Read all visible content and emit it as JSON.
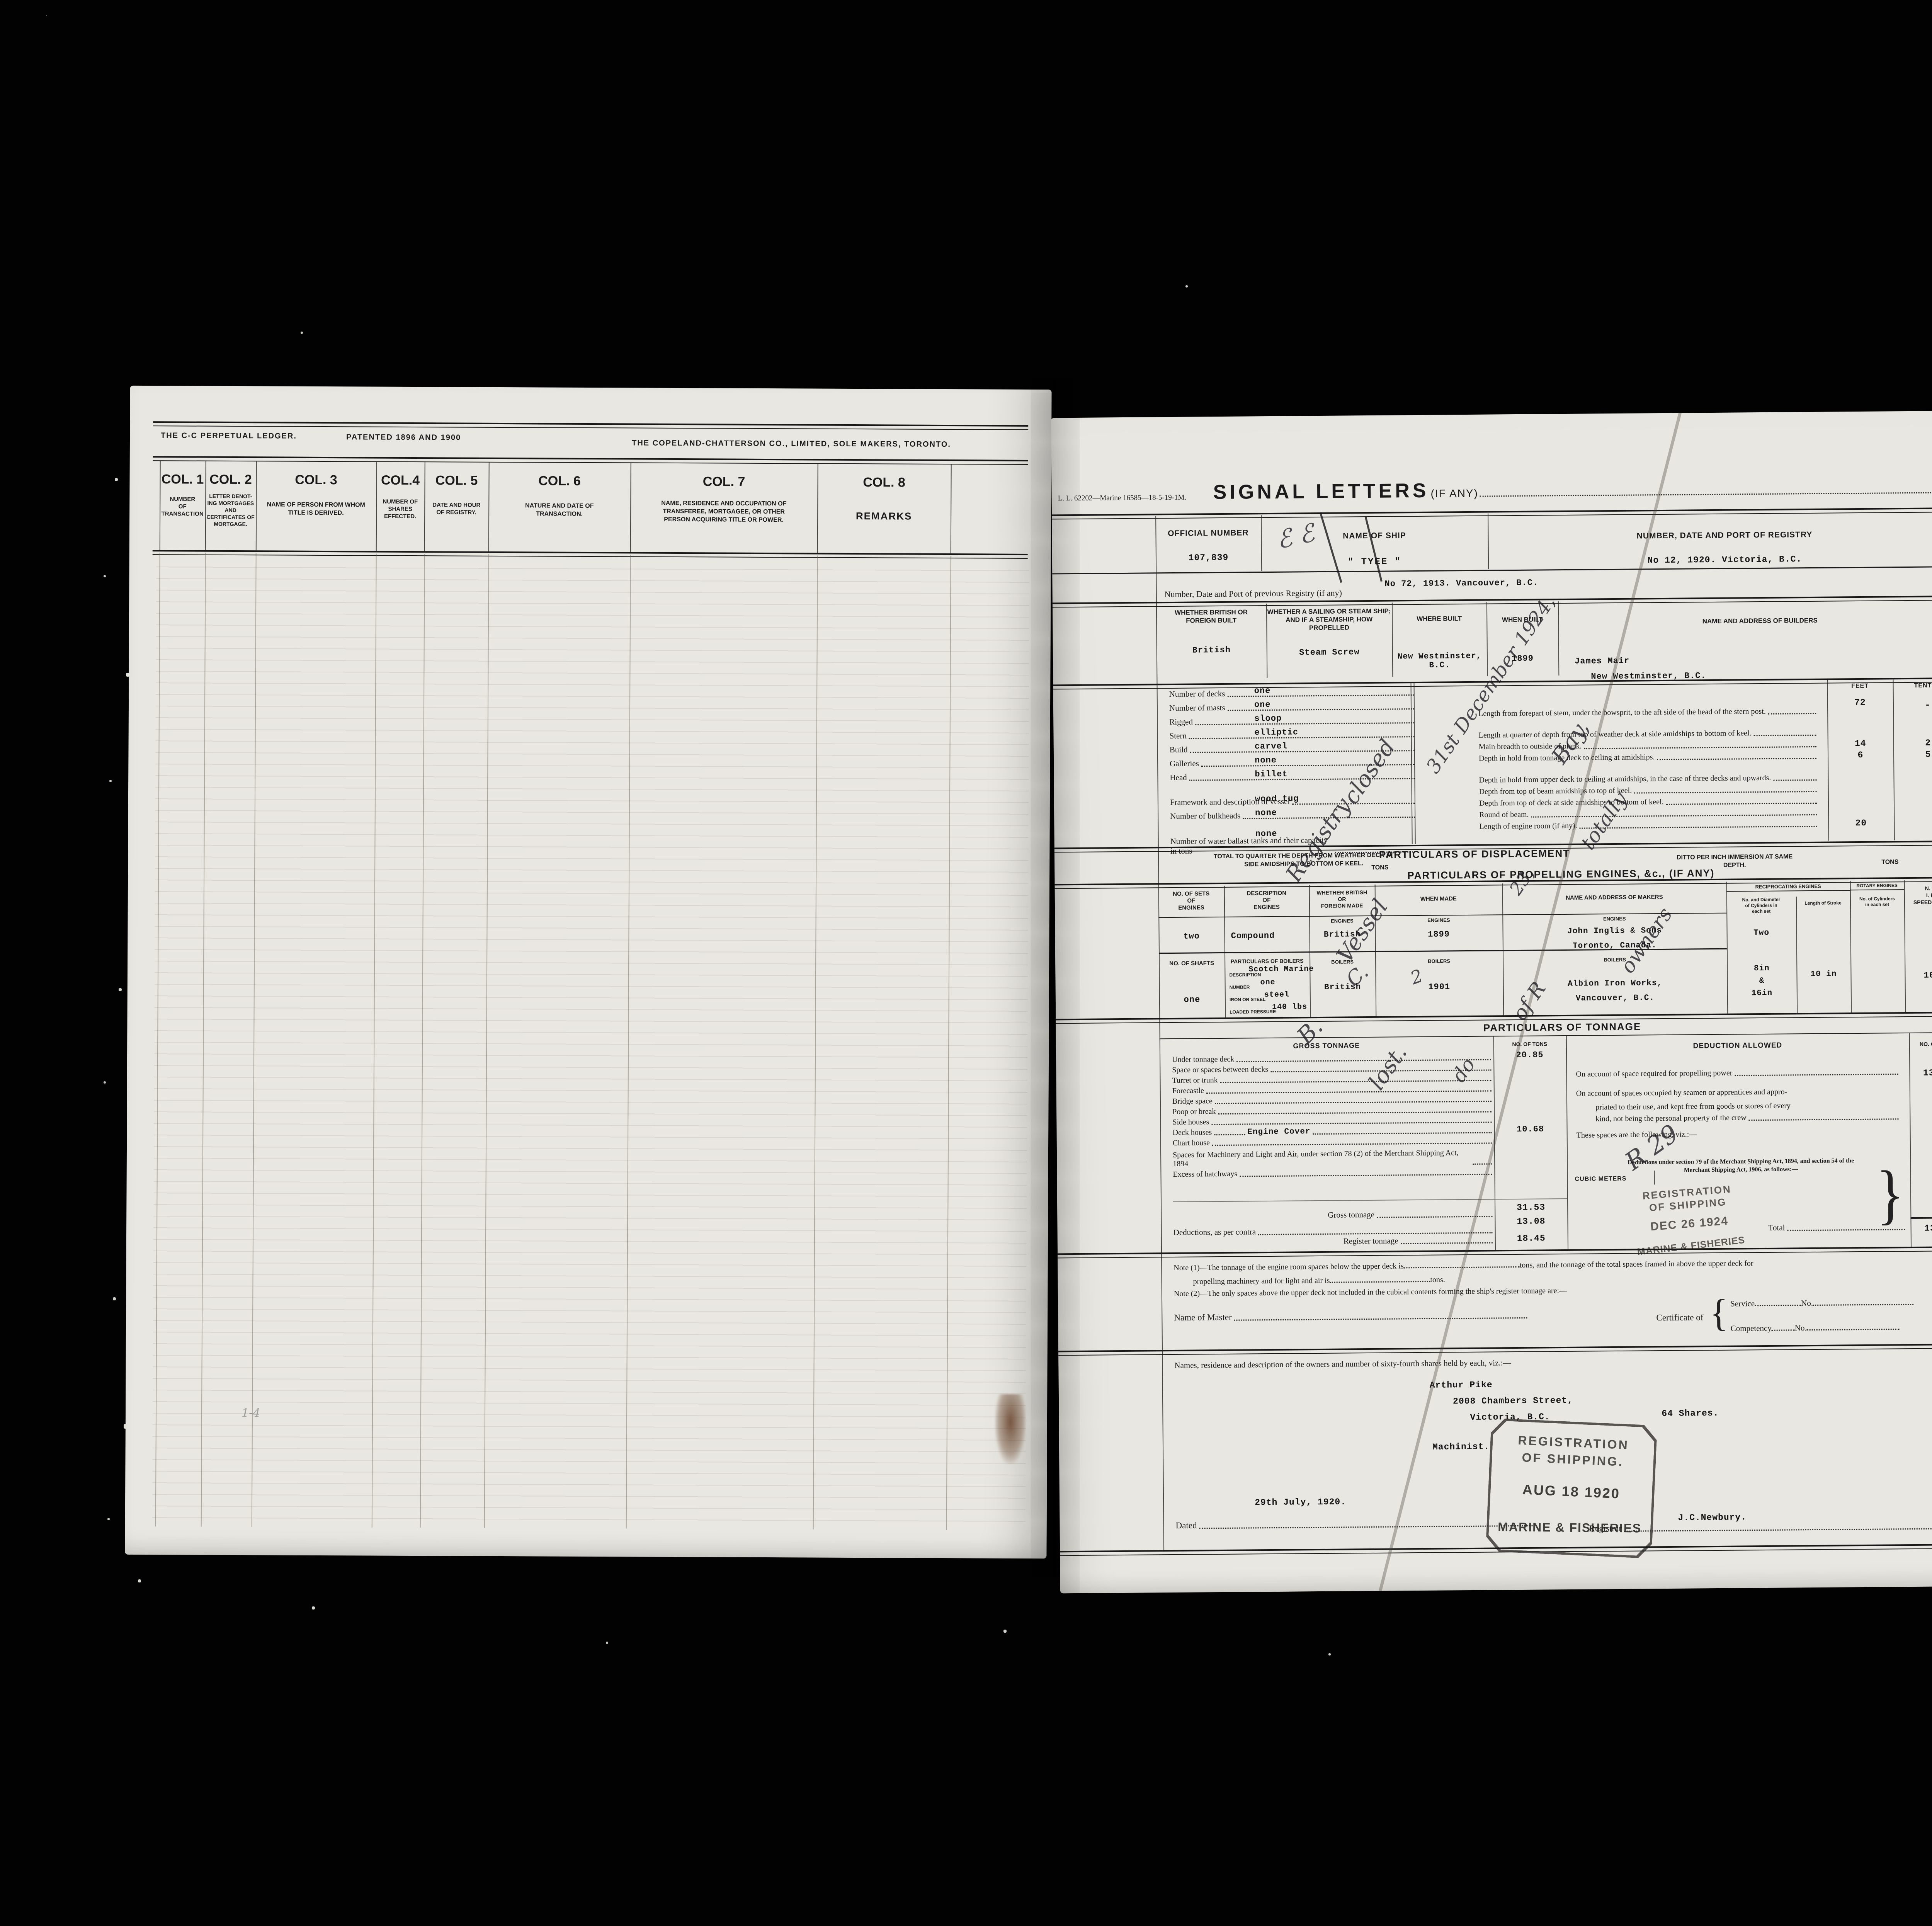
{
  "left_page": {
    "plate": {
      "maker_left": "THE C-C PERPETUAL LEDGER.",
      "patent": "PATENTED 1896 AND 1900",
      "maker_right": "THE COPELAND-CHATTERSON CO., LIMITED, SOLE MAKERS, TORONTO."
    },
    "columns": [
      {
        "title": "COL. 1",
        "desc": "NUMBER\nOF\nTRANSACTION"
      },
      {
        "title": "COL. 2",
        "desc": "LETTER DENOT-\nING MORTGAGES\nAND\nCERTIFICATES OF\nMORTGAGE."
      },
      {
        "title": "COL. 3",
        "desc": "NAME OF PERSON FROM WHOM\nTITLE IS DERIVED."
      },
      {
        "title": "COL.4",
        "desc": "NUMBER OF\nSHARES\nEFFECTED."
      },
      {
        "title": "COL. 5",
        "desc": "DATE AND HOUR\nOF REGISTRY."
      },
      {
        "title": "COL. 6",
        "desc": "NATURE AND DATE OF\nTRANSACTION."
      },
      {
        "title": "COL. 7",
        "desc": "NAME, RESIDENCE AND OCCUPATION OF\nTRANSFEREE, MORTGAGEE, OR OTHER\nPERSON ACQUIRING TITLE OR POWER."
      },
      {
        "title": "COL. 8",
        "desc": "REMARKS"
      }
    ]
  },
  "right_page": {
    "form_no": "L. L. 62202—Marine 16585—18-5-19-1M.",
    "signal": {
      "title": "SIGNAL LETTERS",
      "suffix": "(IF ANY)"
    },
    "registry": {
      "official_label": "OFFICIAL NUMBER",
      "official_value": "107,839",
      "ship_label": "NAME OF SHIP",
      "ship_value": "\" TYEE \"",
      "port_label": "NUMBER, DATE AND PORT OF REGISTRY",
      "port_value": "No 12, 1920. Victoria, B.C.",
      "previous_label": "Number, Date and Port of previous Registry (if any)",
      "previous_value": "No 72, 1913. Vancouver, B.C."
    },
    "build": {
      "h1": "WHETHER BRITISH OR\nFOREIGN BUILT",
      "v1": "British",
      "h2": "WHETHER A SAILING OR STEAM SHIP;\nAND IF A STEAMSHIP, HOW PROPELLED",
      "v2": "Steam Screw",
      "h3": "WHERE BUILT",
      "v3": "New Westminster, B.C.",
      "h4": "WHEN BUILT",
      "v4": "1899",
      "h5": "NAME AND ADDRESS OF BUILDERS",
      "v5a": "James Mair",
      "v5b": "New Westminster, B.C."
    },
    "dims": {
      "left": [
        {
          "label": "Number of decks",
          "value": "one"
        },
        {
          "label": "Number of masts",
          "value": "one"
        },
        {
          "label": "Rigged",
          "value": "sloop"
        },
        {
          "label": "Stern",
          "value": "elliptic"
        },
        {
          "label": "Build",
          "value": "carvel"
        },
        {
          "label": "Galleries",
          "value": "none"
        },
        {
          "label": "Head",
          "value": "billet"
        },
        {
          "label": "Framework and description of vessel",
          "value": "wood tug"
        },
        {
          "label": "Number of bulkheads",
          "value": "none"
        },
        {
          "label": "Number of water ballast tanks and their capacity in tons",
          "value": "none"
        }
      ],
      "feet_label": "FEET",
      "tenths_label": "TENTHS",
      "right": [
        {
          "label": "Length from forepart of stem, under the bowsprit, to the aft side of the head of the stern post.",
          "feet": "72",
          "tenths": "-"
        },
        {
          "label": "Length at quarter of depth from top of weather deck at side amidships to bottom of keel.",
          "feet": "",
          "tenths": ""
        },
        {
          "label": "Main breadth to outside of plank.",
          "feet": "14",
          "tenths": "2"
        },
        {
          "label": "Depth in hold from tonnage deck to ceiling at amidships.",
          "feet": "6",
          "tenths": "5"
        },
        {
          "label": "Depth in hold from upper deck to ceiling at amidships, in the case of three decks and upwards.",
          "feet": "",
          "tenths": ""
        },
        {
          "label": "Depth from top of beam amidships to top of keel.",
          "feet": "",
          "tenths": ""
        },
        {
          "label": "Depth from top of deck at side amidships to bottom of keel.",
          "feet": "",
          "tenths": ""
        },
        {
          "label": "Round of beam.",
          "feet": "",
          "tenths": ""
        },
        {
          "label": "Length of engine room (if any).",
          "feet": "20",
          "tenths": ""
        }
      ]
    },
    "displacement": {
      "total_label": "TOTAL TO QUARTER THE DEPTH FROM WEATHER DECK AT\nSIDE AMIDSHIPS TO BOTTOM OF KEEL.",
      "title": "PARTICULARS OF DISPLACEMENT",
      "tons1": "TONS",
      "ditto": "DITTO PER INCH IMMERSION AT SAME\nDEPTH.",
      "tons2": "TONS"
    },
    "engines": {
      "title": "PARTICULARS OF PROPELLING ENGINES, &c., (IF ANY)",
      "headers": {
        "sets": "NO. OF SETS\nOF\nENGINES",
        "desc": "DESCRIPTION\nOF\nENGINES",
        "origin": "WHETHER BRITISH\nOR\nFOREIGN MADE",
        "when": "WHEN MADE",
        "makers": "NAME AND ADDRESS OF MAKERS",
        "recip": "RECIPROCATING ENGINES",
        "cyl": "No. and Diameter\nof Cylinders in\neach set",
        "stroke": "Length of Stroke",
        "rotary": "ROTARY ENGINES",
        "rotary_sub": "No. of Cylinders\nin each set",
        "nhp": "N. H. P.\nI. H. P.\nSPEED OF SHIP"
      },
      "sub_engines": "ENGINES",
      "sub_boilers": "BOILERS",
      "row_engines": {
        "sets": "two",
        "desc": "Compound",
        "origin": "British",
        "when": "1899",
        "maker1": "John Inglis & Sons",
        "maker2": "Toronto, Canada.",
        "cyl_count": "Two",
        "cyl1": "8in",
        "cyl2": "&",
        "cyl3": "16in",
        "stroke": "10 in",
        "nhp": "10.6"
      },
      "shafts": {
        "label": "NO. OF SHAFTS",
        "value": "one"
      },
      "boilers": {
        "title": "PARTICULARS OF BOILERS",
        "desc_label": "DESCRIPTION",
        "desc": "Scotch Marine",
        "num_label": "NUMBER",
        "num": "one",
        "iron_label": "IRON OR STEEL",
        "iron": "steel",
        "press_label": "LOADED PRESSURE",
        "press": "140 lbs",
        "origin": "British",
        "when": "1901",
        "maker1": "Albion Iron Works,",
        "maker2": "Vancouver, B.C."
      }
    },
    "tonnage": {
      "title": "PARTICULARS OF TONNAGE",
      "gross_header": "GROSS TONNAGE",
      "tons_header": "NO. OF TONS",
      "rows": [
        {
          "label": "Under tonnage deck",
          "value": "20.85"
        },
        {
          "label": "Space or spaces between decks",
          "value": ""
        },
        {
          "label": "Turret or trunk",
          "value": ""
        },
        {
          "label": "Forecastle",
          "value": ""
        },
        {
          "label": "Bridge space",
          "value": ""
        },
        {
          "label": "Poop or break",
          "value": ""
        },
        {
          "label": "Side houses",
          "value": ""
        },
        {
          "label": "Deck houses",
          "value": "10.68"
        },
        {
          "label": "Chart house",
          "value": ""
        },
        {
          "label": "Spaces for Machinery and Light and Air, under section 78 (2) of the Merchant Shipping Act, 1894",
          "value": ""
        },
        {
          "label": "Excess of hatchways",
          "value": ""
        }
      ],
      "engine_cover": "Engine Cover",
      "cubic": "CUBIC METERS",
      "gross_label": "Gross tonnage",
      "gross_value": "31.53",
      "gross_ded": "13.08",
      "contra_label": "Deductions, as per contra",
      "register_label": "Register tonnage",
      "register_value": "18.45",
      "deduction": {
        "header": "DEDUCTION ALLOWED",
        "tons_header": "NO. OF TONS",
        "row1": "On account of space required for propelling power",
        "row1_value": "13.08",
        "row2a": "On account of spaces occupied by seamen or apprentices and appro-",
        "row2b": "priated to their use, and kept free from goods or stores of every",
        "row2c": "kind, not being the personal property of the crew",
        "row3": "These spaces are the following, viz.:—",
        "sections": "Deductions under section 79 of the Merchant Shipping Act, 1894, and section 54 of the\nMerchant Shipping Act, 1906, as follows:—",
        "total_label": "Total",
        "total_value": "13.08"
      }
    },
    "notes": {
      "n1a": "Note (1)—The tonnage of the engine room spaces below the upper deck is",
      "n1b": "tons, and the tonnage of the total spaces framed in above the upper deck for",
      "n1c": "propelling machinery and for light and air is",
      "n1d": "tons.",
      "n2": "Note (2)—The only spaces above the upper deck not included in the cubical contents forming the ship's register tonnage are:—"
    },
    "master": {
      "label": "Name of Master",
      "cert": "Certificate of",
      "service": "Service",
      "service_no": "No.",
      "competency": "Competency",
      "competency_no": "No."
    },
    "owners": {
      "intro": "Names, residence and description of the owners and number of sixty-fourth shares held by each, viz.:—",
      "name": "Arthur Pike",
      "street": "2008 Chambers Street,",
      "city": "Victoria, B.C.",
      "shares": "64 Shares.",
      "occupation": "Machinist.",
      "date": "29th July, 1920.",
      "dated_label": "Dated",
      "registrar_label": "Registrar",
      "registrar": "J.C.Newbury."
    },
    "stamps": {
      "dec": {
        "l1": "REGISTRATION",
        "l2": "OF SHIPPING",
        "l3": "DEC 26 1924",
        "l4": "MARINE & FISHERIES"
      },
      "aug": {
        "l1": "REGISTRATION",
        "l2": "OF SHIPPING.",
        "l3": "AUG 18 1920",
        "l4": "MARINE & FISHERIES"
      }
    }
  },
  "handwriting": [
    {
      "text": "ℰ ℰ"
    },
    {
      "text": "Registry"
    },
    {
      "text": "closed"
    },
    {
      "text": "Vessel"
    },
    {
      "text": "31st December 1924,"
    },
    {
      "text": "Bay,"
    },
    {
      "text": "totally"
    },
    {
      "text": "lost."
    },
    {
      "text": "of R"
    },
    {
      "text": "owners"
    },
    {
      "text": "R 29"
    },
    {
      "text": "B."
    },
    {
      "text": "C."
    },
    {
      "text": "2"
    },
    {
      "text": "23,"
    },
    {
      "text": "do"
    },
    {
      "text": "1-4"
    }
  ]
}
